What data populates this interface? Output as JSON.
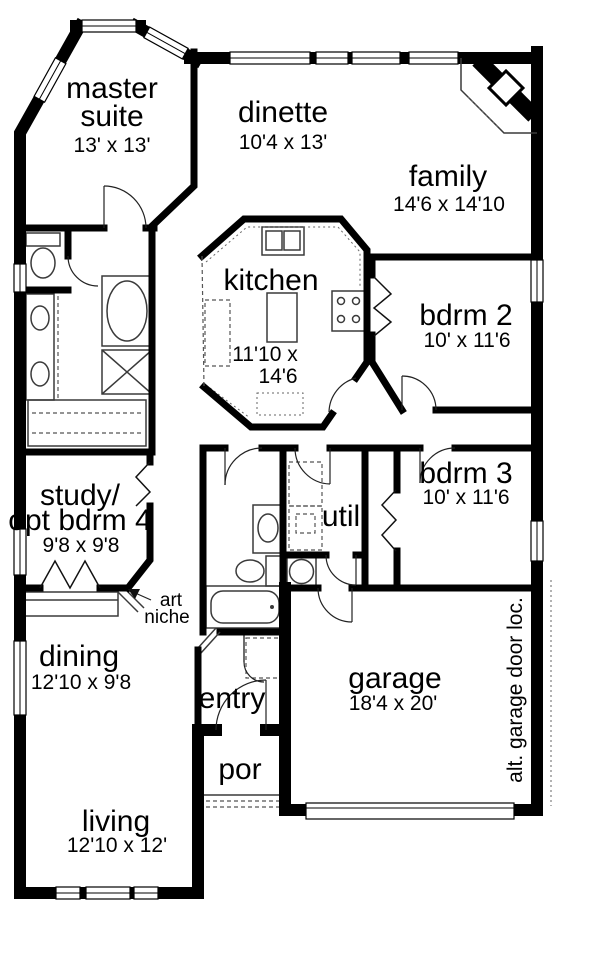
{
  "rooms": {
    "master_suite": {
      "lines": [
        "master",
        "suite"
      ],
      "dims": "13' x 13'"
    },
    "dinette": {
      "lines": [
        "dinette"
      ],
      "dims": "10'4 x 13'"
    },
    "family": {
      "lines": [
        "family"
      ],
      "dims": "14'6 x 14'10"
    },
    "kitchen": {
      "lines": [
        "kitchen"
      ],
      "dims_lines": [
        "11'10 x",
        "14'6"
      ]
    },
    "bdrm2": {
      "lines": [
        "bdrm 2"
      ],
      "dims": "10' x 11'6"
    },
    "bdrm3": {
      "lines": [
        "bdrm 3"
      ],
      "dims": "10' x 11'6"
    },
    "util": {
      "lines": [
        "util"
      ]
    },
    "study": {
      "lines": [
        "study/",
        "opt bdrm 4"
      ],
      "dims": "9'8 x 9'8"
    },
    "dining": {
      "lines": [
        "dining"
      ],
      "dims": "12'10 x 9'8"
    },
    "entry": {
      "lines": [
        "entry"
      ]
    },
    "porch": {
      "lines": [
        "por"
      ]
    },
    "garage": {
      "lines": [
        "garage"
      ],
      "dims": "18'4 x 20'"
    },
    "living": {
      "lines": [
        "living"
      ],
      "dims": "12'10 x 12'"
    }
  },
  "annotations": {
    "art_niche": {
      "lines": [
        "art",
        "niche"
      ]
    },
    "alt_garage_door": "alt. garage door loc."
  },
  "colors": {
    "walls": "#000000",
    "background": "#ffffff",
    "fixtures": "#3a3a3a"
  }
}
